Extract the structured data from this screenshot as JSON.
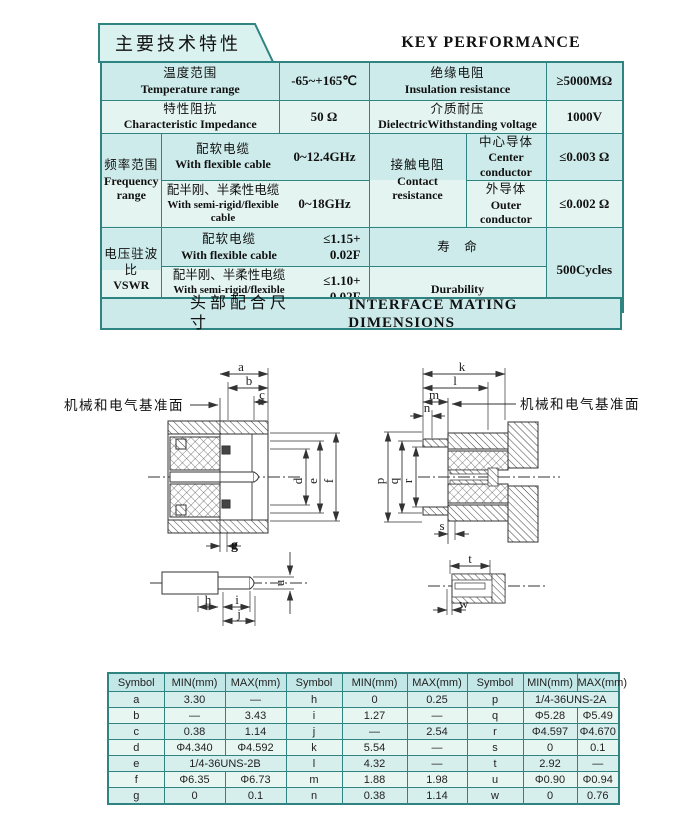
{
  "header": {
    "title_cn": "主要技术特性",
    "title_en": "KEY PERFORMANCE"
  },
  "spec_table": {
    "temperature": {
      "cn": "温度范围",
      "en": "Temperature range",
      "value": "-65~+165℃"
    },
    "insulation": {
      "cn": "绝缘电阻",
      "en": "Insulation resistance",
      "value": "≥5000MΩ"
    },
    "impedance": {
      "cn": "特性阻抗",
      "en": "Characteristic Impedance",
      "value": "50 Ω"
    },
    "withstanding": {
      "cn": "介质耐压",
      "en": "DielectricWithstanding voltage",
      "value": "1000V"
    },
    "frequency": {
      "cn": "频率范围",
      "en": "Frequency range"
    },
    "freq_flexible": {
      "cn": "配软电缆",
      "en": "With flexible cable",
      "value": "0~12.4GHz"
    },
    "freq_semirigid": {
      "cn": "配半刚、半柔性电缆",
      "en": "With semi-rigid/flexible cable",
      "value": "0~18GHz"
    },
    "contact": {
      "cn": "接触电阻",
      "en": "Contact resistance"
    },
    "center_conductor": {
      "cn": "中心导体",
      "en": "Center conductor",
      "value": "≤0.003  Ω"
    },
    "outer_conductor": {
      "cn": "外导体",
      "en": "Outer conductor",
      "value": "≤0.002  Ω"
    },
    "vswr": {
      "cn": "电压驻波比",
      "en": "VSWR"
    },
    "vswr_flexible": {
      "cn": "配软电缆",
      "en": "With flexible cable",
      "value_line1": "≤1.15+",
      "value_line2": "0.02F"
    },
    "vswr_semirigid": {
      "cn": "配半刚、半柔性电缆",
      "en": "With semi-rigid/flexible cable",
      "value_line1": "≤1.10+",
      "value_line2": "0.02F"
    },
    "durability": {
      "cn": "寿　命",
      "en": "Durability",
      "value": "500Cycles"
    }
  },
  "mating_section": {
    "title_cn": "头部配合尺寸",
    "title_en": "INTERFACE MATING DIMENSIONS"
  },
  "drawings": {
    "ref_plane_label_left": "机械和电气基准面",
    "ref_plane_label_right": "机械和电气基准面",
    "dim_labels": {
      "a": "a",
      "b": "b",
      "c": "c",
      "d": "d",
      "e": "e",
      "f": "f",
      "g": "g",
      "h": "h",
      "i": "i",
      "j": "j",
      "u": "u",
      "k": "k",
      "l": "l",
      "m": "m",
      "n": "n",
      "p": "p",
      "q": "q",
      "r": "r",
      "s": "s",
      "t": "t",
      "w": "w"
    }
  },
  "dim_table": {
    "headers": [
      "Symbol",
      "MIN(mm)",
      "MAX(mm)",
      "Symbol",
      "MIN(mm)",
      "MAX(mm)",
      "Symbol",
      "MIN(mm)",
      "MAX(mm)"
    ],
    "rows": [
      [
        "a",
        "3.30",
        "—",
        "h",
        "0",
        "0.25",
        "p",
        "1/4-36UNS-2A"
      ],
      [
        "b",
        "—",
        "3.43",
        "i",
        "1.27",
        "—",
        "q",
        "Φ5.28",
        "Φ5.49"
      ],
      [
        "c",
        "0.38",
        "1.14",
        "j",
        "—",
        "2.54",
        "r",
        "Φ4.597",
        "Φ4.670"
      ],
      [
        "d",
        "Φ4.340",
        "Φ4.592",
        "k",
        "5.54",
        "—",
        "s",
        "0",
        "0.1"
      ],
      [
        "e",
        "1/4-36UNS-2B",
        "l",
        "4.32",
        "—",
        "t",
        "2.92",
        "—"
      ],
      [
        "f",
        "Φ6.35",
        "Φ6.73",
        "m",
        "1.88",
        "1.98",
        "u",
        "Φ0.90",
        "Φ0.94"
      ],
      [
        "g",
        "0",
        "0.1",
        "n",
        "0.38",
        "1.14",
        "w",
        "0",
        "0.76"
      ]
    ]
  },
  "colors": {
    "border": "#2f8381",
    "row_medium": "#cdebea",
    "row_light": "#e4f4f0"
  }
}
